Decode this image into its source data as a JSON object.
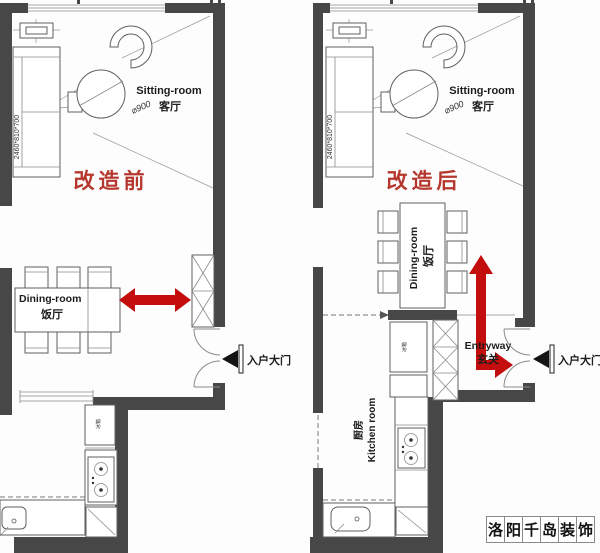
{
  "colors": {
    "wall": "#474747",
    "furniture_line": "#5f5f5f",
    "red_arrow": "#c40d0d",
    "red_phase_text": "#b5372e"
  },
  "left_plan": {
    "phase_label": "改造前",
    "sitting_room": {
      "name_en": "Sitting-room",
      "name_zh": "客厅",
      "sofa_dimension": "2460*810*700",
      "table_diameter": "⌀900"
    },
    "dining_room": {
      "name_en": "Dining-room",
      "name_zh": "饭厅"
    },
    "kitchen": {
      "fridge_label": "冰箱"
    },
    "entrance_label": "入户大门"
  },
  "right_plan": {
    "phase_label": "改造后",
    "sitting_room": {
      "name_en": "Sitting-room",
      "name_zh": "客厅",
      "sofa_dimension": "2460*810*700",
      "table_diameter": "⌀900"
    },
    "dining_room": {
      "name_en": "Dining-room",
      "name_zh": "饭厅"
    },
    "entryway": {
      "name_en": "Entryway",
      "name_zh": "玄关"
    },
    "kitchen": {
      "name_zh": "厨房",
      "name_en": "Kitchen room",
      "fridge_label": "冰箱"
    },
    "entrance_label": "入户大门"
  },
  "watermark": {
    "text": "洛阳千岛装饰",
    "chars": [
      "洛",
      "阳",
      "千",
      "岛",
      "装",
      "饰"
    ]
  }
}
